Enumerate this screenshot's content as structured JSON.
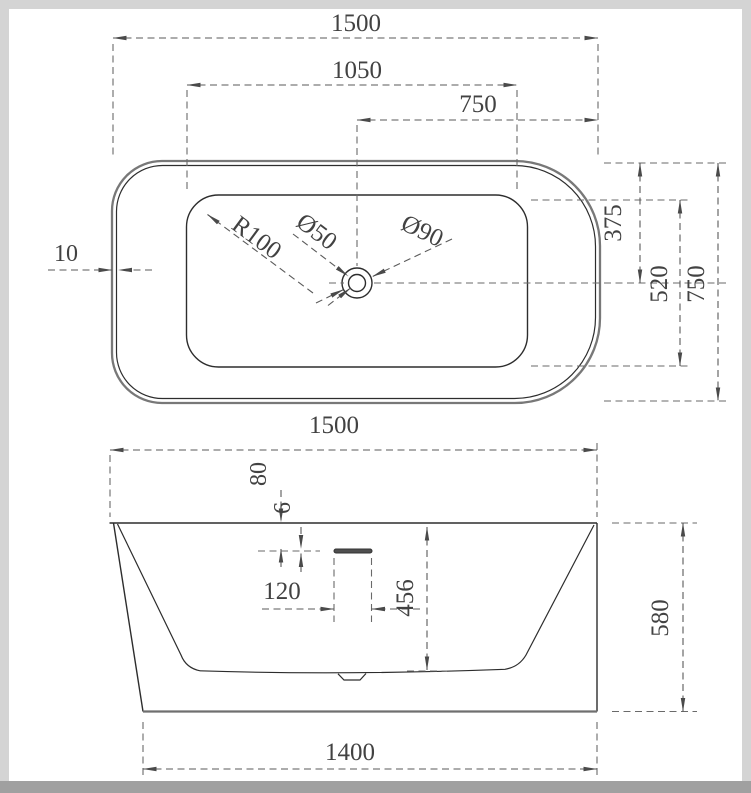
{
  "drawing": {
    "top_view": {
      "dim_length": "1500",
      "dim_inner_length": "1050",
      "dim_drain_offset": "750",
      "dim_wall_thickness": "10",
      "dim_drain_from_back": "375",
      "dim_inner_width": "520",
      "dim_width": "750",
      "label_corner_radius": "R100",
      "label_drain_diameter": "Ø50",
      "label_waste_diameter": "Ø90"
    },
    "front_view": {
      "dim_length": "1500",
      "dim_overflow_from_rim": "80",
      "dim_overflow_slot_height": "6",
      "dim_overflow_slot_width": "120",
      "dim_inner_depth": "456",
      "dim_height": "580",
      "dim_base_length": "1400"
    }
  }
}
